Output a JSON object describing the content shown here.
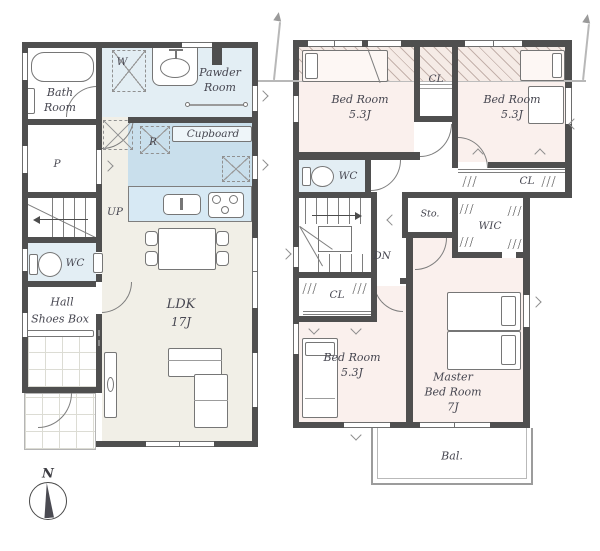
{
  "colors": {
    "wall": "#4f4f4f",
    "floor_wood": "#f1efe7",
    "floor_pink": "#faf0ed",
    "water_blue": "#e3eef4",
    "kitchen_blue": "#c9dfec",
    "counter_blue": "#d7e9f4",
    "hatch_bg": "#f5ebe6",
    "line": "#7a7a7a",
    "roofline": "#b8b8b8"
  },
  "floor1": {
    "bath": [
      "Bath",
      "Room"
    ],
    "washer": "W",
    "powder": [
      "Pawder",
      "Room"
    ],
    "cupboard": "Cupboard",
    "fridge": "R",
    "pantry": "P",
    "stairs": "UP",
    "wc": "WC",
    "hall": "Hall",
    "shoes_box": "Shoes Box",
    "ldk": [
      "LDK",
      "17J"
    ]
  },
  "floor2": {
    "bedroom1": [
      "Bed Room",
      "5.3J"
    ],
    "bedroom2": [
      "Bed Room",
      "5.3J"
    ],
    "bedroom3": [
      "Bed Room",
      "5.3J"
    ],
    "master": [
      "Master",
      "Bed Room",
      "7J"
    ],
    "closet_mid": "CL",
    "closet_right": "CL",
    "closet_left": "CL",
    "wc": "WC",
    "storage": "Sto.",
    "stairs": "DN",
    "wic": "WIC",
    "balcony": "Bal."
  },
  "compass": {
    "north": "N"
  }
}
